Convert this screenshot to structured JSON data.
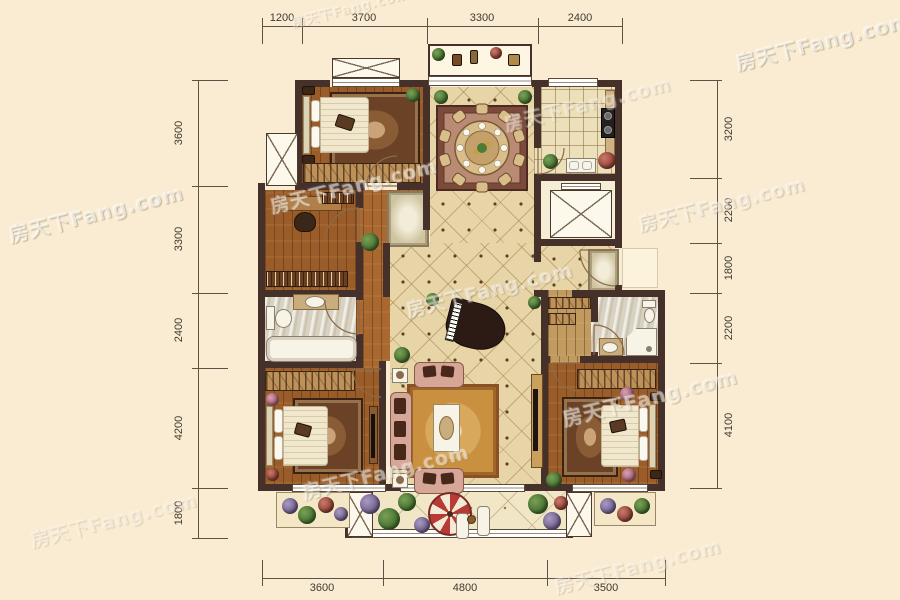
{
  "watermark": {
    "text": "房天下Fang.com"
  },
  "dimensions": {
    "top": [
      "1200",
      "3700",
      "3300",
      "2400"
    ],
    "bottom": [
      "3600",
      "4800",
      "3500"
    ],
    "left": [
      "3600",
      "3300",
      "2400",
      "4200",
      "1800"
    ],
    "right": [
      "3200",
      "2200",
      "1800",
      "2200",
      "4100"
    ]
  },
  "colors": {
    "background": "#faecd2",
    "wall": "#46302a",
    "wood_floor": "#9a5c28",
    "tile_floor": "#e7d5a8",
    "kitchen_tile": "#ece0ba",
    "bath_floor": "#d9d2c0",
    "living_rug": "#c9913f",
    "bedroom_rug": "#6b4226",
    "sofa": "#d6a797",
    "plant_green": "#4e7c38",
    "umbrella_red": "#b83a34",
    "dimension_text": "#3f3a30"
  },
  "icons": {
    "elevator": "box-with-x",
    "shaft": "box-with-x",
    "window": "white-band",
    "door": "quarter-arc",
    "bed": "headboard-pillows-blanket",
    "dining_table": "round-table-10-chairs",
    "piano": "grand-piano",
    "umbrella": "red-white-parasol",
    "wardrobe": "hatched-strip",
    "bathtub": "rounded-rect",
    "toilet": "tank-and-bowl",
    "shower": "corner-stall",
    "stove": "two-burner-cooktop",
    "plant": "green-circle"
  }
}
